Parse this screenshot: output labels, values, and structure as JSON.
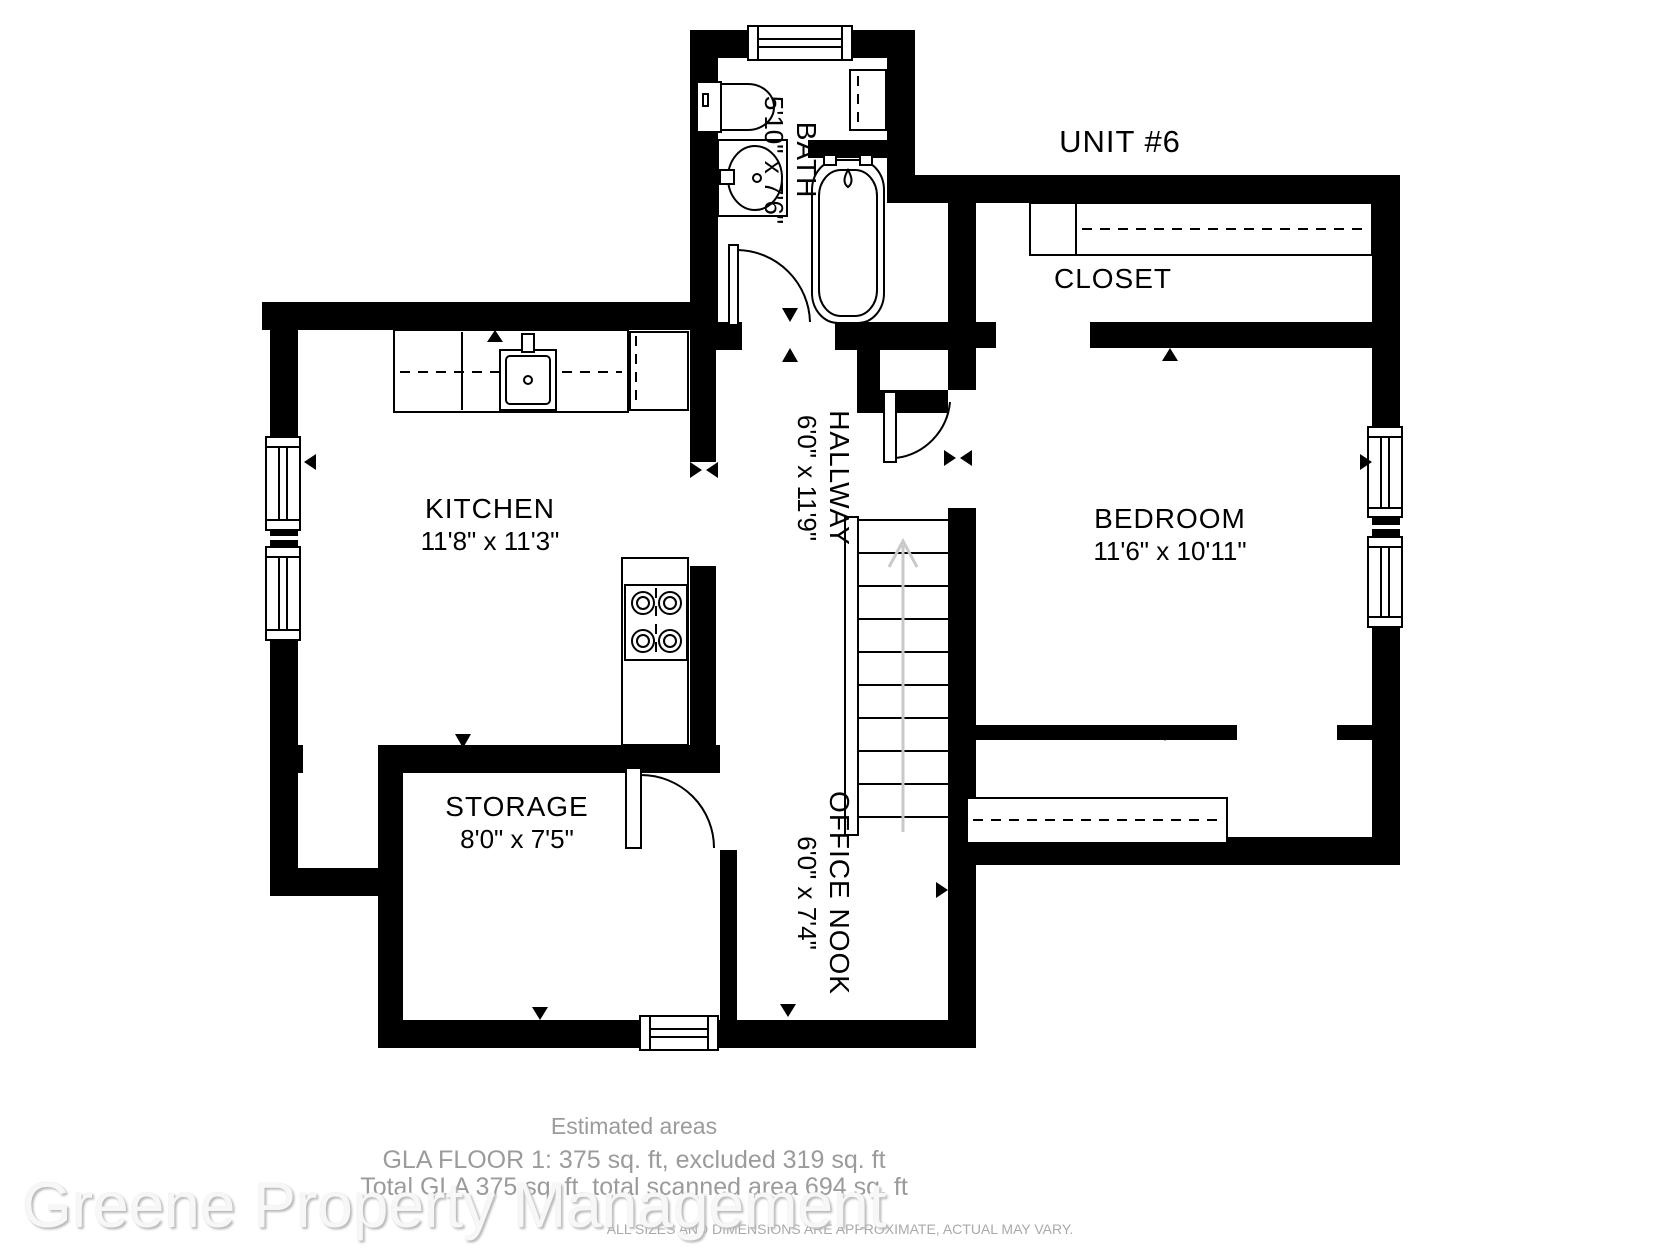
{
  "unit": {
    "label": "UNIT #6"
  },
  "rooms": {
    "bath": {
      "name": "BATH",
      "dims": "5'10\" x 7'6\""
    },
    "closet": {
      "name": "CLOSET"
    },
    "bedroom": {
      "name": "BEDROOM",
      "dims": "11'6\" x 10'11\""
    },
    "kitchen": {
      "name": "KITCHEN",
      "dims": "11'8\" x 11'3\""
    },
    "hallway": {
      "name": "HALLWAY",
      "dims": "6'0\" x 11'9\""
    },
    "storage": {
      "name": "STORAGE",
      "dims": "8'0\" x 7'5\""
    },
    "office_nook": {
      "name": "OFFICE NOOK",
      "dims": "6'0\" x 7'4\""
    }
  },
  "footer": {
    "title": "Estimated areas",
    "gla_line": "GLA FLOOR 1: 375 sq. ft, excluded 319 sq. ft",
    "total_line": "Total GLA 375 sq. ft, total scanned area 694 sq. ft",
    "disclaimer": "ALL SIZES AND DIMENSIONS ARE APPROXIMATE, ACTUAL MAY VARY."
  },
  "watermark": {
    "text": "Greene Property Management"
  },
  "colors": {
    "wall": "#000000",
    "footer_text": "#9b9b9b",
    "watermark": "#f6f6f6",
    "stairs_arrow": "#c9c9c9"
  }
}
